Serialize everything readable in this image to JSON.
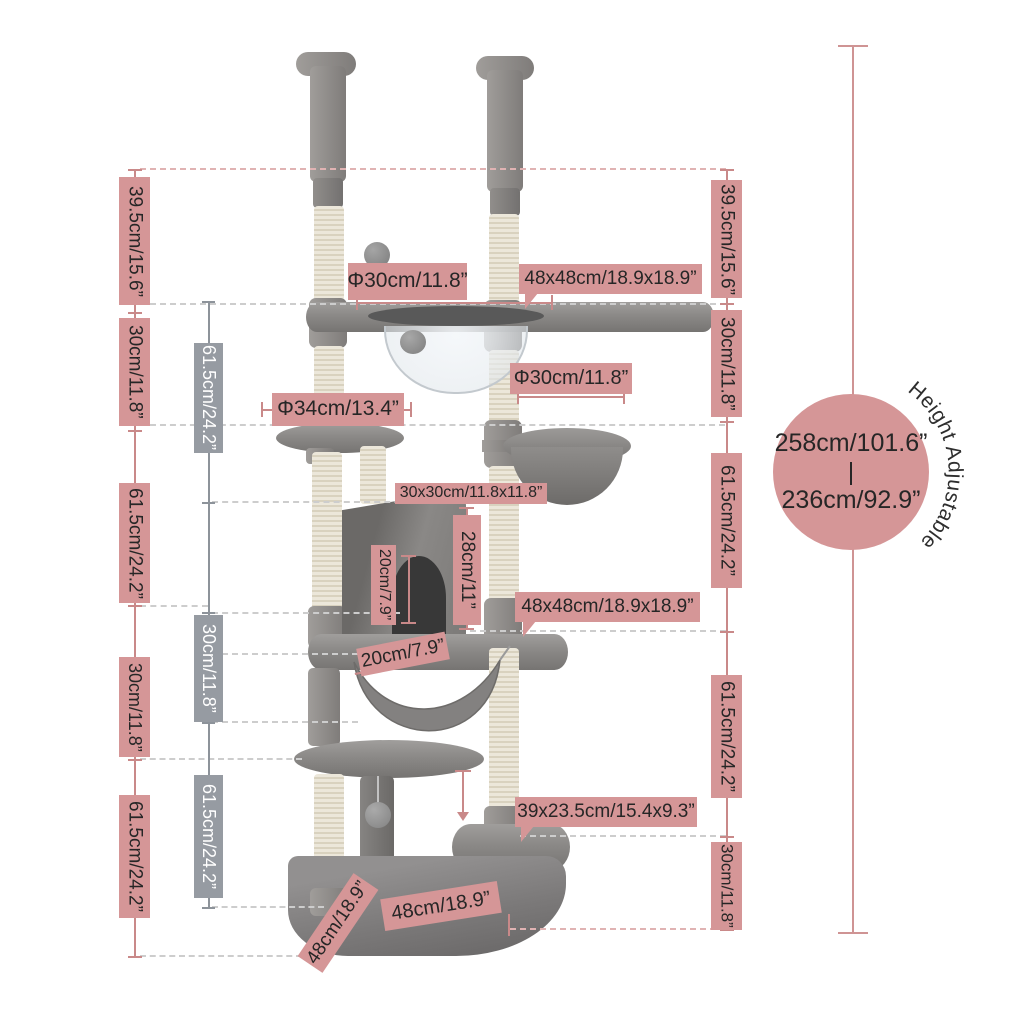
{
  "palette": {
    "accent_pink": "#d59697",
    "accent_gray": "#969ba2",
    "line_pink": "#c98989",
    "line_gray": "#8d939a",
    "dash_gray": "#cdcdcd",
    "label_text_dark": "#262626",
    "label_text_light": "#ffffff"
  },
  "left_column": [
    "39.5cm/15.6”",
    "30cm/11.8”",
    "61.5cm/24.2”",
    "30cm/11.8”",
    "61.5cm/24.2”"
  ],
  "inner_column": [
    "61.5cm/24.2”",
    "30cm/11.8”",
    "61.5cm/24.2”"
  ],
  "right_column": [
    "39.5cm/15.6”",
    "30cm/11.8”",
    "61.5cm/24.2”",
    "61.5cm/24.2”",
    "30cm/11.8”"
  ],
  "callouts": {
    "top_hole_diameter": "Φ30cm/11.8”",
    "top_platform_size": "48x48cm/18.9x18.9”",
    "hanging_basket_diameter": "Φ30cm/11.8”",
    "round_perch_diameter": "Φ34cm/13.4”",
    "condo_footprint": "30x30cm/11.8x11.8”",
    "condo_height": "28cm/11”",
    "door_height": "20cm/7.9”",
    "door_width": "20cm/7.9”",
    "middle_platform_size": "48x48cm/18.9x18.9”",
    "step_size": "39x23.5cm/15.4x9.3”",
    "base_side": "48cm/18.9”",
    "base_front": "48cm/18.9”"
  },
  "height_badge": {
    "max": "258cm/101.6”",
    "divider": "|",
    "min": "236cm/92.9”",
    "note": "Height Adjustable"
  }
}
